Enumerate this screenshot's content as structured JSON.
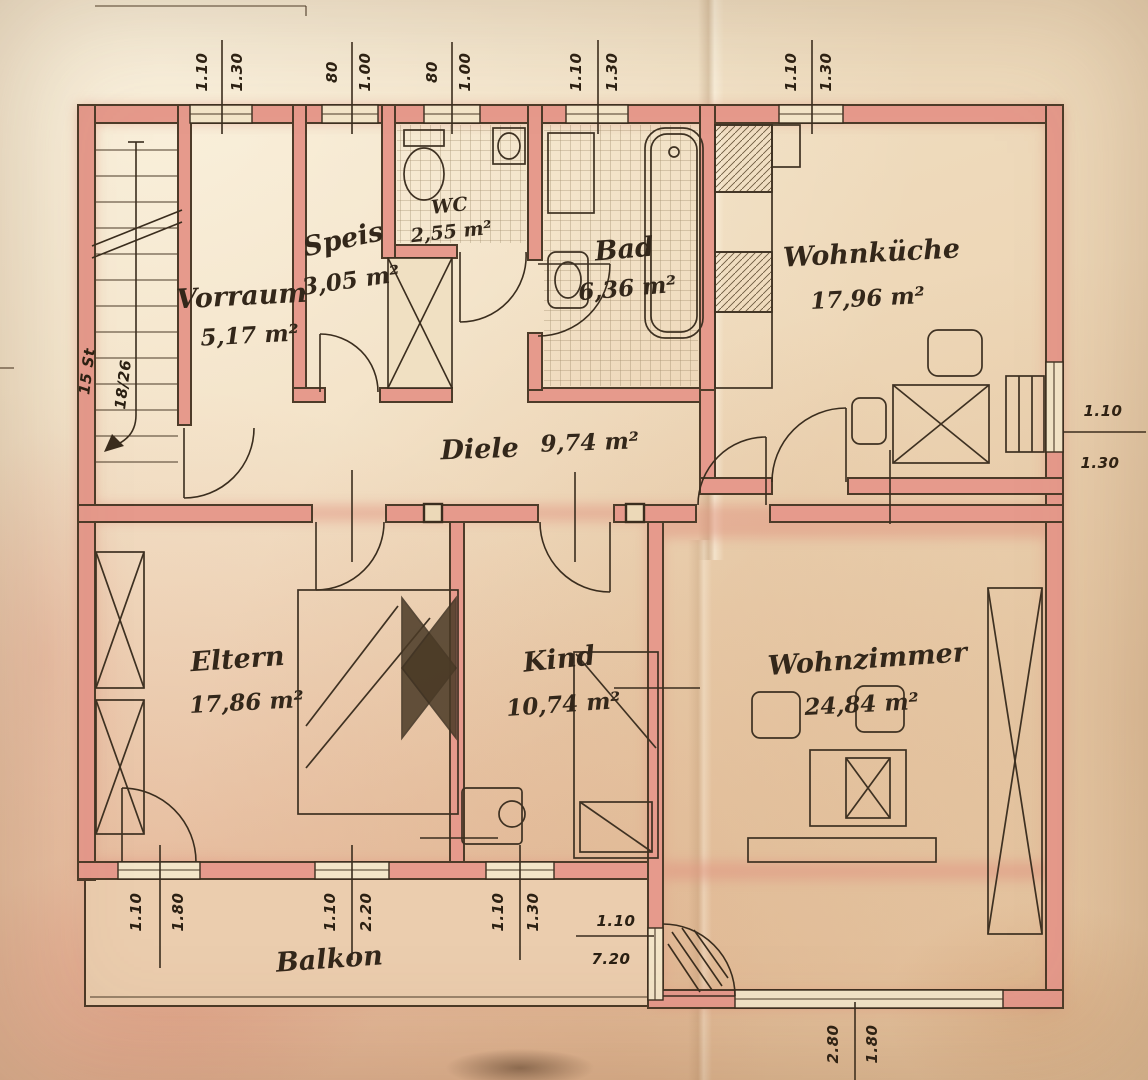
{
  "rooms": {
    "vorraum": {
      "name": "Vorraum",
      "area": "5,17 m²"
    },
    "speis": {
      "name": "Speis",
      "area": "3,05 m²"
    },
    "wc": {
      "name": "WC",
      "area": "2,55 m²"
    },
    "bad": {
      "name": "Bad",
      "area": "6,36 m²"
    },
    "wohnkueche": {
      "name": "Wohnküche",
      "area": "17,96 m²"
    },
    "diele": {
      "name": "Diele",
      "area": "9,74 m²"
    },
    "eltern": {
      "name": "Eltern",
      "area": "17,86 m²"
    },
    "kind": {
      "name": "Kind",
      "area": "10,74 m²"
    },
    "wohnzimmer": {
      "name": "Wohnzimmer",
      "area": "24,84 m²"
    },
    "balkon": {
      "name": "Balkon"
    }
  },
  "dims": {
    "top": [
      {
        "w": "1.10",
        "h": "1.30"
      },
      {
        "w": "80",
        "h": "1.00"
      },
      {
        "w": "80",
        "h": "1.00"
      },
      {
        "w": "1.10",
        "h": "1.30"
      },
      {
        "w": "1.10",
        "h": "1.30"
      }
    ],
    "right": {
      "w": "1.10",
      "h": "1.30"
    },
    "bottom": [
      {
        "w": "1.10",
        "h": "1.80"
      },
      {
        "w": "1.10",
        "h": "2.20"
      },
      {
        "w": "1.10",
        "h": "1.30"
      }
    ],
    "balcony": {
      "w": "1.10",
      "h": "7.20"
    },
    "wz_window": {
      "w": "2.80",
      "h": "1.80"
    },
    "stair": {
      "line1": "15 St",
      "line2": "18/26"
    }
  },
  "colors": {
    "paper": "#eed9ba",
    "wall_fill": "#e69a8c",
    "ink": "#3a2d1e",
    "pink_wash": "#e8b4a2"
  }
}
